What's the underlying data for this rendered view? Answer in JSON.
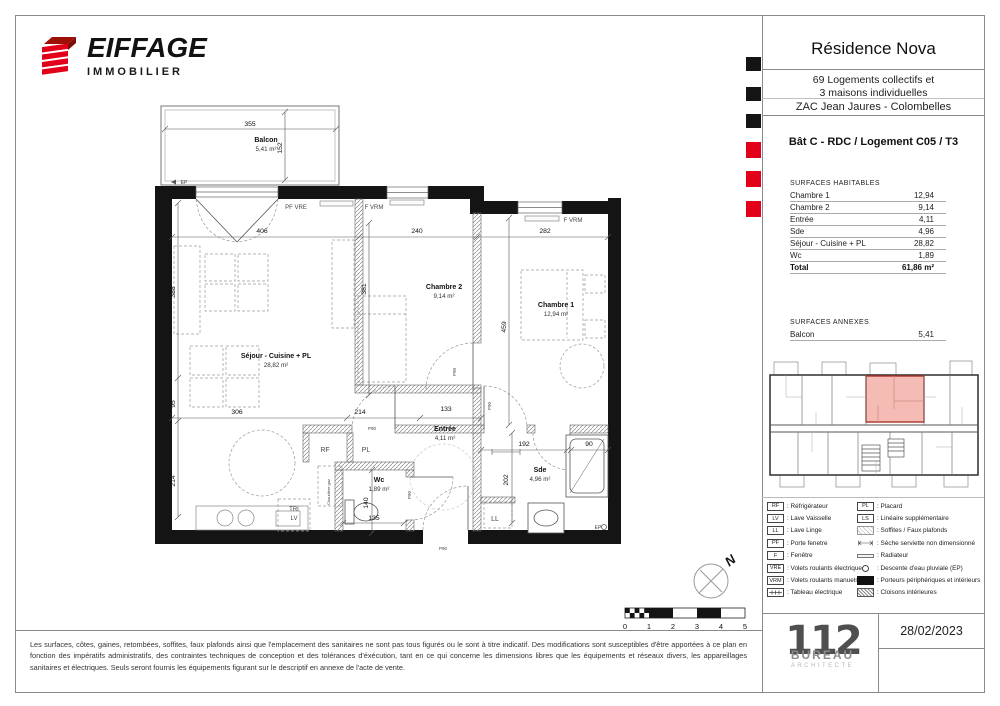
{
  "header": {
    "brand": "EIFFAGE",
    "brand_sub": "IMMOBILIER"
  },
  "title_block": {
    "residence": "Résidence Nova",
    "program_line1": "69 Logements collectifs et",
    "program_line2": "3 maisons individuelles",
    "location": "ZAC Jean Jaures - Colombelles",
    "unit": "Bât C - RDC / Logement C05 / T3"
  },
  "surfaces_habitables": {
    "title": "SURFACES HABITABLES",
    "rows": [
      [
        "Chambre 1",
        "12,94"
      ],
      [
        "Chambre 2",
        "9,14"
      ],
      [
        "Entrée",
        "4,11"
      ],
      [
        "Sde",
        "4,96"
      ],
      [
        "Séjour - Cuisine + PL",
        "28,82"
      ],
      [
        "Wc",
        "1,89"
      ]
    ],
    "total_label": "Total",
    "total_value": "61,86 m²"
  },
  "surfaces_annexes": {
    "title": "SURFACES ANNEXES",
    "rows": [
      [
        "Balcon",
        "5,41"
      ]
    ]
  },
  "legend": {
    "left": [
      {
        "type": "box",
        "code": "RF",
        "label": "Réfrigérateur"
      },
      {
        "type": "box",
        "code": "LV",
        "label": "Lave Vaisselle"
      },
      {
        "type": "box",
        "code": "LL",
        "label": "Lave Linge"
      },
      {
        "type": "box",
        "code": "PF",
        "label": "Porte fenetre"
      },
      {
        "type": "box",
        "code": "F",
        "label": "Fenêtre"
      },
      {
        "type": "box",
        "code": "VRE",
        "label": "Volets roulants électriques"
      },
      {
        "type": "box",
        "code": "VRM",
        "label": "Volets roulants manuels"
      },
      {
        "type": "tableau",
        "code": "",
        "label": "Tableau électrique"
      }
    ],
    "right": [
      {
        "type": "box",
        "code": "PL",
        "label": "Placard"
      },
      {
        "type": "box",
        "code": "LS",
        "label": "Linéaire supplémentaire"
      },
      {
        "type": "hatchl",
        "code": "",
        "label": "Soffites / Faux plafonds"
      },
      {
        "type": "arrow",
        "code": "",
        "label": "Sèche serviette non dimensionné"
      },
      {
        "type": "radiator",
        "code": "",
        "label": "Radiateur"
      },
      {
        "type": "circle",
        "code": "",
        "label": "Descente d'eau pluviale (EP)"
      },
      {
        "type": "black",
        "code": "",
        "label": "Porteurs périphériques et intérieurs"
      },
      {
        "type": "hatchd",
        "code": "",
        "label": "Cloisons intérieures"
      }
    ]
  },
  "footer": {
    "date": "28/02/2023",
    "logo_number": "112",
    "logo_text": "BUREAU",
    "logo_sub": "ARCHITECTE"
  },
  "disclaimer": "Les surfaces, côtes, gaines, retombées, soffites, faux plafonds ainsi que l'emplacement des sanitaires ne sont pas tous figurés ou le sont à titre indicatif. Des modifications sont susceptibles d'être apportées à ce plan en fonction des impératifs administratifs, des contraintes techniques de conception et des tolérances d'éxécution, tant en ce qui concerne les dimensions libres que les équipements et réseaux divers, les appareillages sanitaires et électriques. Seuls seront fournis les équipements figurant sur le descriptif en annexe de l'acte de vente.",
  "plan": {
    "north": "N",
    "scale_numbers": [
      "0",
      "1",
      "2",
      "3",
      "4",
      "5"
    ],
    "rooms": [
      {
        "name": "Balcon",
        "area": "5,41 m²",
        "x": 266,
        "y": 142
      },
      {
        "name": "Séjour - Cuisine + PL",
        "area": "28,82 m²",
        "x": 276,
        "y": 358
      },
      {
        "name": "Chambre 2",
        "area": "9,14 m²",
        "x": 444,
        "y": 289
      },
      {
        "name": "Chambre 1",
        "area": "12,94 m²",
        "x": 556,
        "y": 307
      },
      {
        "name": "Entrée",
        "area": "4,11 m²",
        "x": 445,
        "y": 431
      },
      {
        "name": "Sde",
        "area": "4,96 m²",
        "x": 540,
        "y": 472
      },
      {
        "name": "Wc",
        "area": "1,89 m²",
        "x": 379,
        "y": 482
      }
    ],
    "dimensions": [
      {
        "v": "355",
        "x": 250,
        "y": 126
      },
      {
        "v": "152",
        "x": 282,
        "y": 148,
        "r": -90
      },
      {
        "v": "406",
        "x": 262,
        "y": 233
      },
      {
        "v": "240",
        "x": 417,
        "y": 233
      },
      {
        "v": "282",
        "x": 545,
        "y": 233
      },
      {
        "v": "388",
        "x": 175,
        "y": 292,
        "r": -90
      },
      {
        "v": "381",
        "x": 366,
        "y": 289,
        "r": -90
      },
      {
        "v": "459",
        "x": 506,
        "y": 327,
        "r": -90
      },
      {
        "v": "306",
        "x": 237,
        "y": 414
      },
      {
        "v": "214",
        "x": 360,
        "y": 414
      },
      {
        "v": "133",
        "x": 446,
        "y": 411
      },
      {
        "v": "95",
        "x": 175,
        "y": 404,
        "r": -90
      },
      {
        "v": "214",
        "x": 175,
        "y": 481,
        "r": -90
      },
      {
        "v": "192",
        "x": 524,
        "y": 446
      },
      {
        "v": "90",
        "x": 589,
        "y": 446
      },
      {
        "v": "202",
        "x": 508,
        "y": 480,
        "r": -90
      },
      {
        "v": "140",
        "x": 368,
        "y": 503,
        "r": -90
      },
      {
        "v": "135",
        "x": 374,
        "y": 520
      }
    ],
    "labels": [
      {
        "t": "PF VRE",
        "x": 296,
        "y": 209
      },
      {
        "t": "F VRM",
        "x": 374,
        "y": 209
      },
      {
        "t": "F VRM",
        "x": 573,
        "y": 222
      },
      {
        "t": "RF",
        "x": 325,
        "y": 452,
        "s": 7
      },
      {
        "t": "PL",
        "x": 366,
        "y": 452,
        "s": 7
      },
      {
        "t": "LL",
        "x": 495,
        "y": 521,
        "s": 7
      },
      {
        "t": "TRI",
        "x": 294,
        "y": 511,
        "s": 6
      },
      {
        "t": "LV",
        "x": 294,
        "y": 520,
        "s": 6
      },
      {
        "t": "EP",
        "x": 184,
        "y": 184,
        "s": 5
      },
      {
        "t": "EP",
        "x": 598,
        "y": 529,
        "s": 5
      },
      {
        "t": "P90",
        "x": 456,
        "y": 372,
        "r": -90,
        "s": 4.5
      },
      {
        "t": "P90",
        "x": 491,
        "y": 406,
        "r": -90,
        "s": 4.5
      },
      {
        "t": "P90",
        "x": 372,
        "y": 430,
        "s": 4.5
      },
      {
        "t": "P90",
        "x": 443,
        "y": 550,
        "s": 4.5
      },
      {
        "t": "P90",
        "x": 411,
        "y": 495,
        "r": -90,
        "s": 4.5
      },
      {
        "t": "Chaudière gaz",
        "x": 330,
        "y": 492,
        "r": -90,
        "s": 4
      }
    ]
  },
  "colors": {
    "accent_red": "#e2001a",
    "unit_pink": "#f5bcb6",
    "wall_black": "#141414"
  }
}
